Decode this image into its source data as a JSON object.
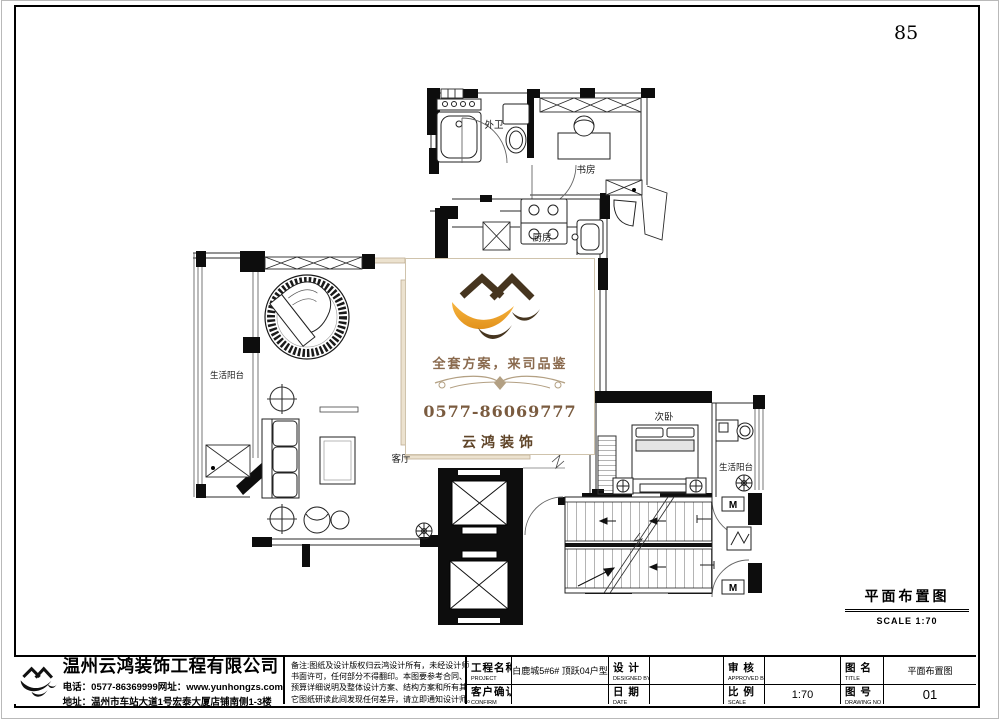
{
  "page": {
    "number": "85"
  },
  "plan": {
    "door_marker": "M",
    "rooms": {
      "outer_bath": "外卫",
      "study": "书房",
      "kitchen": "厨房",
      "living": "客厅",
      "balcony_left": "生活阳台",
      "bedroom2": "次卧",
      "balcony_right": "生活阳台"
    }
  },
  "watermark": {
    "slogan": "全套方案，来司品鉴",
    "phone": "0577-86069777",
    "brand": "云鸿装饰",
    "colors": {
      "house": "#46351f",
      "swoosh": "#f0a32c",
      "text": "#8a6a4e"
    }
  },
  "drawing_label": {
    "title": "平面布置图",
    "scale": "SCALE 1:70"
  },
  "title_block": {
    "company": {
      "name": "温州云鸿装饰工程有限公司",
      "phone_line": "电话：0577-86369999网址：www.yunhongzs.com",
      "address_line": "地址：温州市车站大道1号宏泰大厦店铺南侧1-3楼"
    },
    "note_lines": [
      "备注:图纸及设计版权归云鸿设计所有，未经设计师",
      "书面许可，任何部分不得翻印。本图要参考合同、",
      "预算详细说明及整体设计方案、结构方案和所有其",
      "它图纸研读此间发现任何差异，请立即通知设计师。"
    ],
    "fields": {
      "project_label": "工程名称",
      "project_en": "PROJECT",
      "project_value": "白鹿城5#6# 顶跃04户型",
      "confirm_label": "客户确认",
      "confirm_en": "CONFIRM",
      "confirm_value": "",
      "design_label": "设 计",
      "design_en": "DESIGNED BY",
      "design_value": "",
      "date_label": "日 期",
      "date_en": "DATE",
      "date_value": "",
      "approve_label": "审 核",
      "approve_en": "APPROVED BY",
      "approve_value": "",
      "scale_label": "比 例",
      "scale_en": "SCALE",
      "scale_value": "1:70",
      "title_label": "图 名",
      "title_en": "TITLE",
      "title_value": "平面布置图",
      "dwgno_label": "图 号",
      "dwgno_en": "DRAWING NO",
      "dwgno_value": "01"
    }
  }
}
